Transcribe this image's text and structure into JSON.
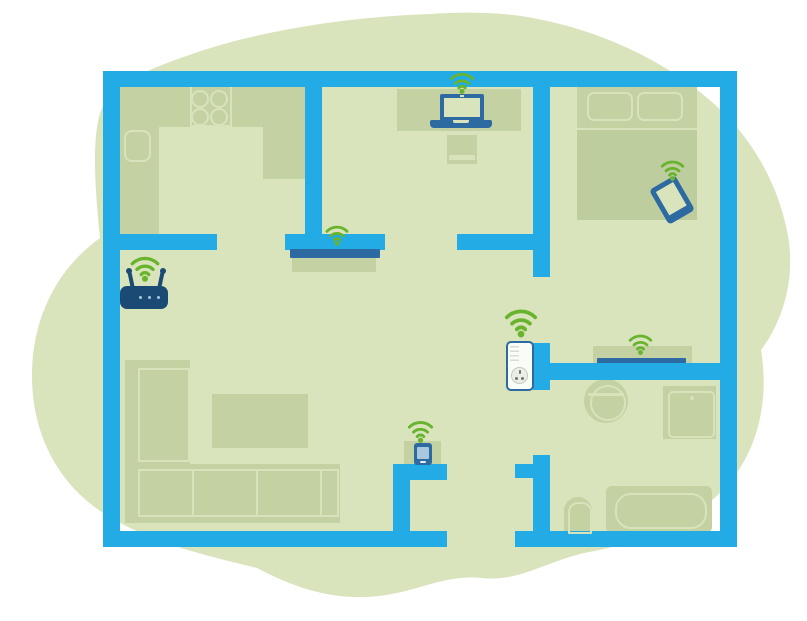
{
  "scene": {
    "kind": "home-floor-plan-illustration",
    "description": "Apartment floor plan on a green organic blob showing whole-home Wi-Fi coverage from a router via a powerline Wi-Fi extender plugged into a wall socket",
    "wifi_signal_count": 7
  },
  "colors": {
    "background": "#ffffff",
    "blob": "#d9e4bc",
    "wall": "#22abe5",
    "furniture": "#c3d1a3",
    "furniture_shade": "#bdcd9e",
    "furniture_outline": "#d8e3bb",
    "device_blue": "#2e6aa2",
    "router_blue": "#1b4a74",
    "wifi_green": "#69b42e",
    "extender_body": "#fafcf7",
    "extender_border": "#2e6aa2",
    "socket_face": "#eceee6",
    "socket_pins": "#6f7570",
    "router_leds": "#a9c8de"
  },
  "rooms": [
    {
      "name": "kitchen",
      "position": "top-left",
      "furniture": [
        "l-shaped-counter",
        "stove-4-burners",
        "sink"
      ]
    },
    {
      "name": "office",
      "position": "top-middle",
      "furniture": [
        "desk",
        "chair"
      ]
    },
    {
      "name": "bedroom",
      "position": "top-right",
      "furniture": [
        "double-bed",
        "two-pillows",
        "media-shelf"
      ]
    },
    {
      "name": "living-room",
      "position": "bottom-left",
      "furniture": [
        "corner-sofa",
        "coffee-table",
        "tv-cabinet"
      ]
    },
    {
      "name": "hallway",
      "position": "bottom-middle",
      "furniture": [
        "cabinet"
      ],
      "note": "front-door opening in bottom wall"
    },
    {
      "name": "bathroom",
      "position": "right",
      "furniture": [
        "washbasin",
        "shower",
        "toilet",
        "bathtub"
      ]
    }
  ],
  "devices": [
    {
      "name": "wifi-router",
      "location": "living-room, against left wall",
      "has_wifi_signal": true
    },
    {
      "name": "laptop",
      "location": "office desk",
      "has_wifi_signal": true
    },
    {
      "name": "smartphone",
      "location": "bedroom, on bed, tilted",
      "has_wifi_signal": true
    },
    {
      "name": "tv",
      "location": "living-room wall shelf",
      "has_wifi_signal": true
    },
    {
      "name": "media-device",
      "location": "bedroom shelf by bathroom wall",
      "has_wifi_signal": true
    },
    {
      "name": "powerline-wifi-extender",
      "location": "wall socket at hallway/bathroom wall",
      "has_wifi_signal": true
    },
    {
      "name": "smart-home-device",
      "location": "hallway cabinet",
      "has_wifi_signal": true
    }
  ]
}
